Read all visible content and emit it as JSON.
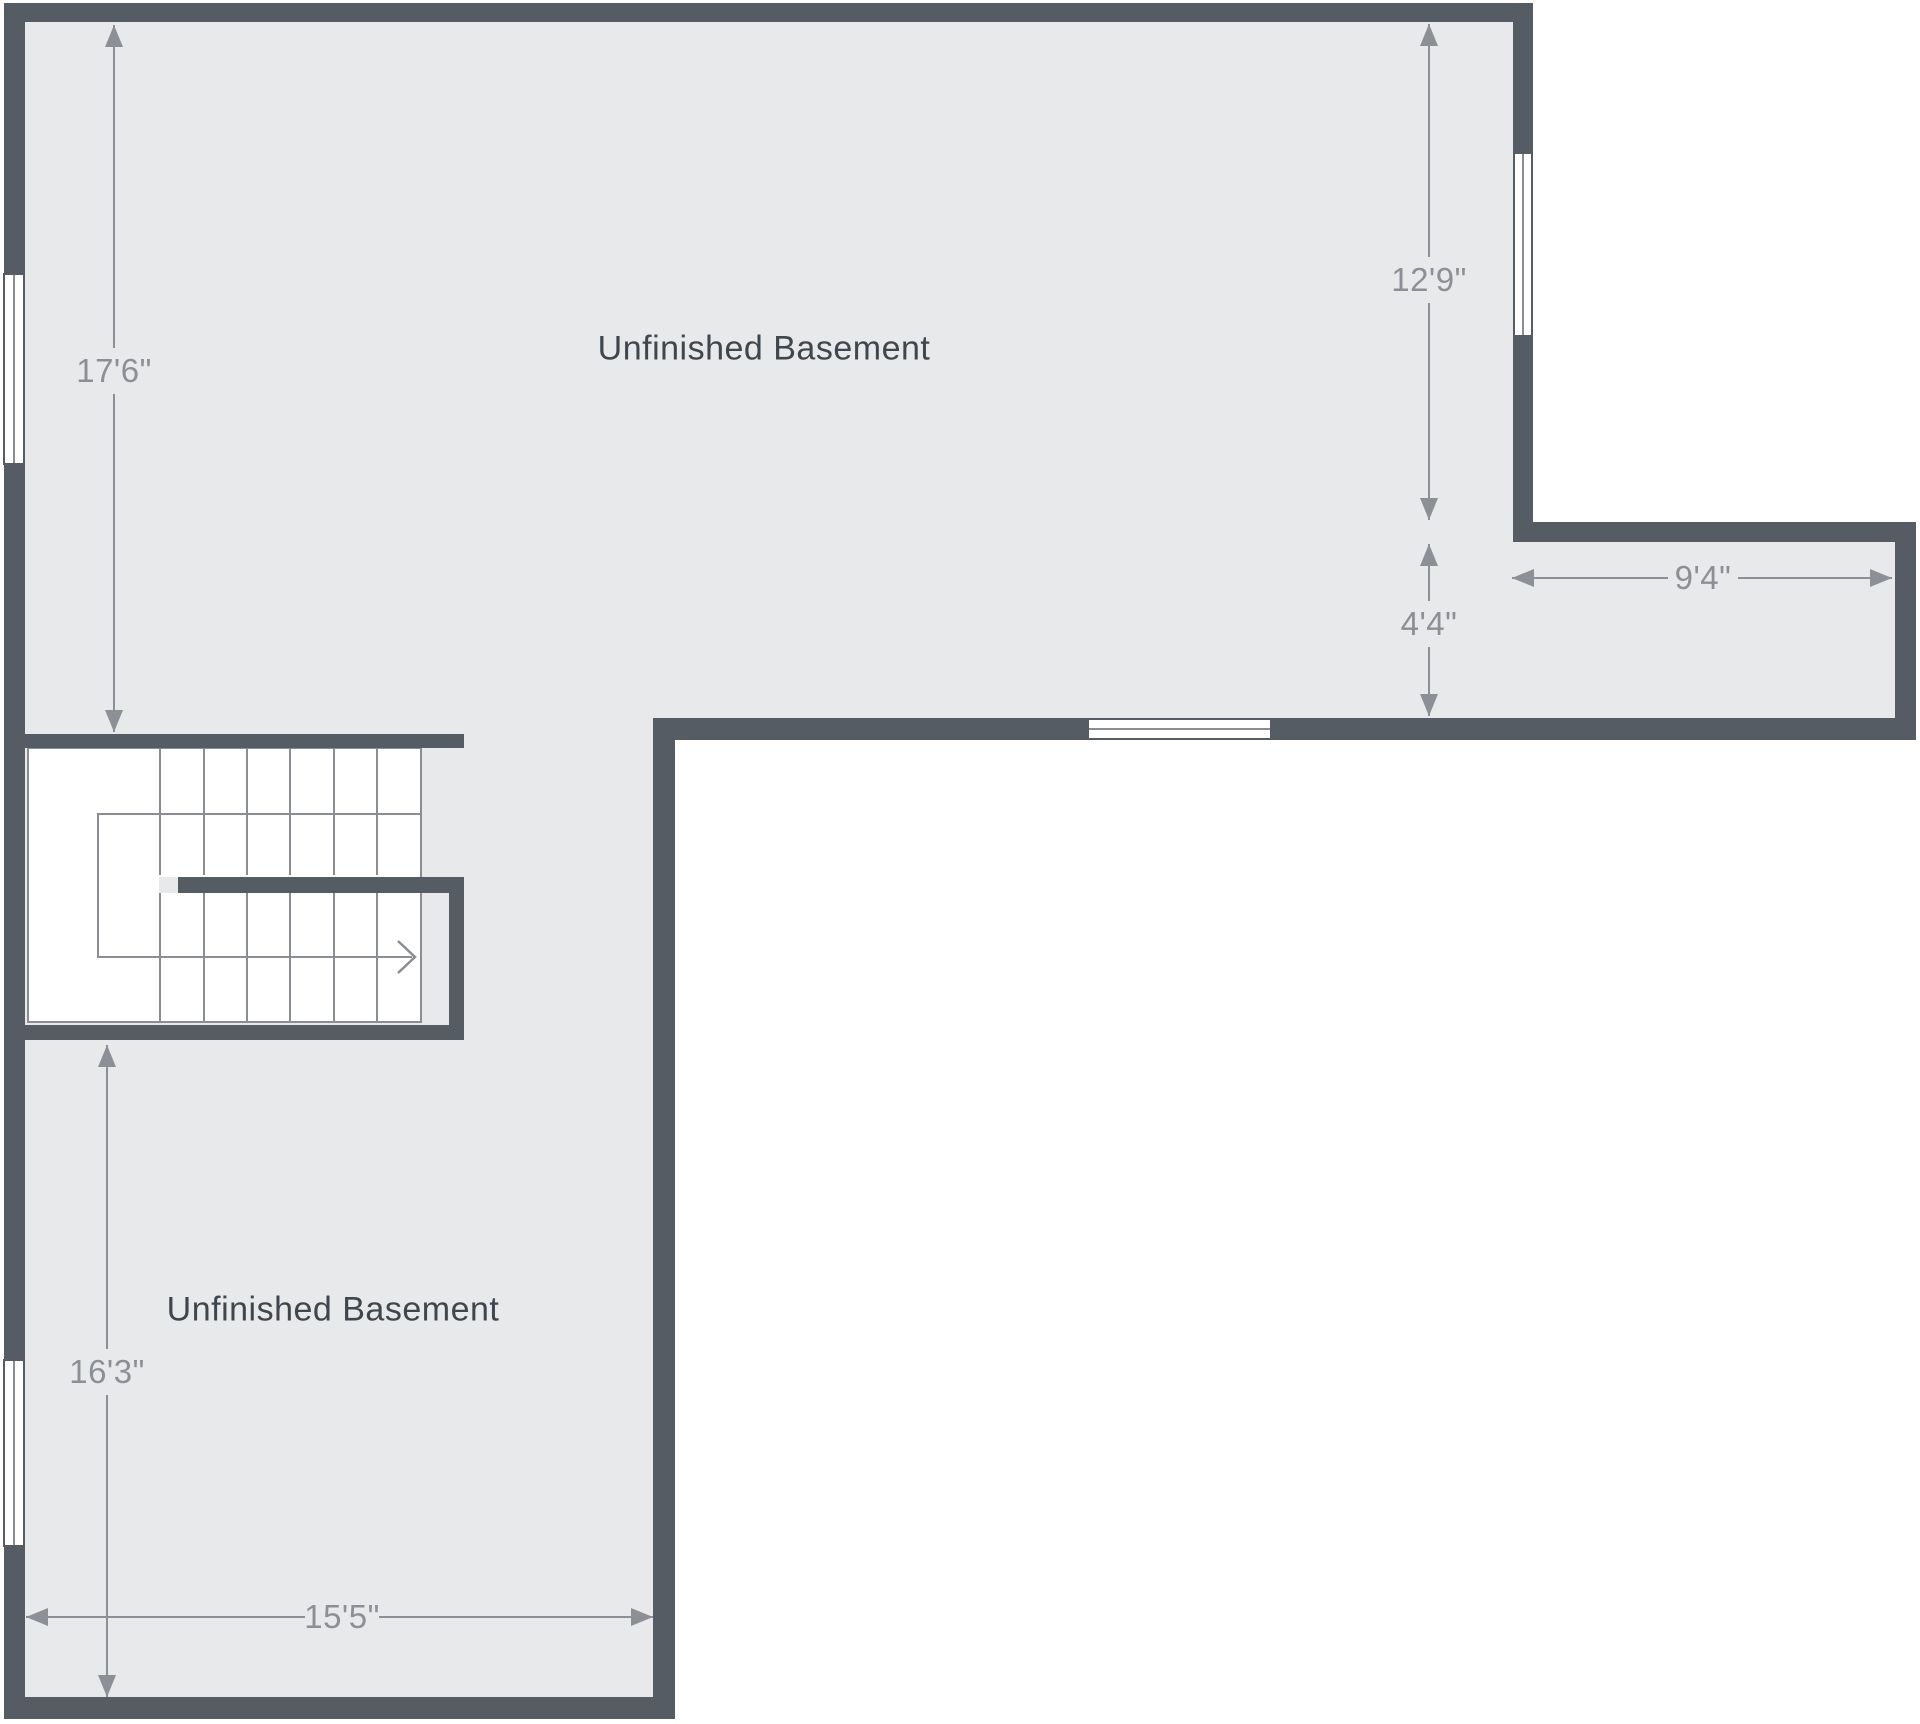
{
  "colors": {
    "wall": "#565C63",
    "floor": "#E8E9EA",
    "dimension": "#8C9096",
    "room_label": "#3F464E",
    "stair_line": "#8A8E93",
    "window_fill": "#FFFFFF",
    "background": "#FFFFFF"
  },
  "rooms": [
    {
      "label": "Unfinished Basement"
    },
    {
      "label": "Unfinished Basement"
    }
  ],
  "dimensions": [
    {
      "label": "17'6\"",
      "orientation": "vertical"
    },
    {
      "label": "12'9\"",
      "orientation": "vertical"
    },
    {
      "label": "4'4\"",
      "orientation": "vertical"
    },
    {
      "label": "9'4\"",
      "orientation": "horizontal"
    },
    {
      "label": "16'3\"",
      "orientation": "vertical"
    },
    {
      "label": "15'5\"",
      "orientation": "horizontal"
    }
  ],
  "windows": [
    {
      "wall": "left-upper",
      "orientation": "vertical"
    },
    {
      "wall": "left-lower",
      "orientation": "vertical"
    },
    {
      "wall": "right-upper",
      "orientation": "vertical"
    },
    {
      "wall": "bottom-upper-area",
      "orientation": "horizontal"
    }
  ],
  "stairs": {
    "upper_flight_treads": 6,
    "lower_flight_treads": 6,
    "direction": "right"
  }
}
